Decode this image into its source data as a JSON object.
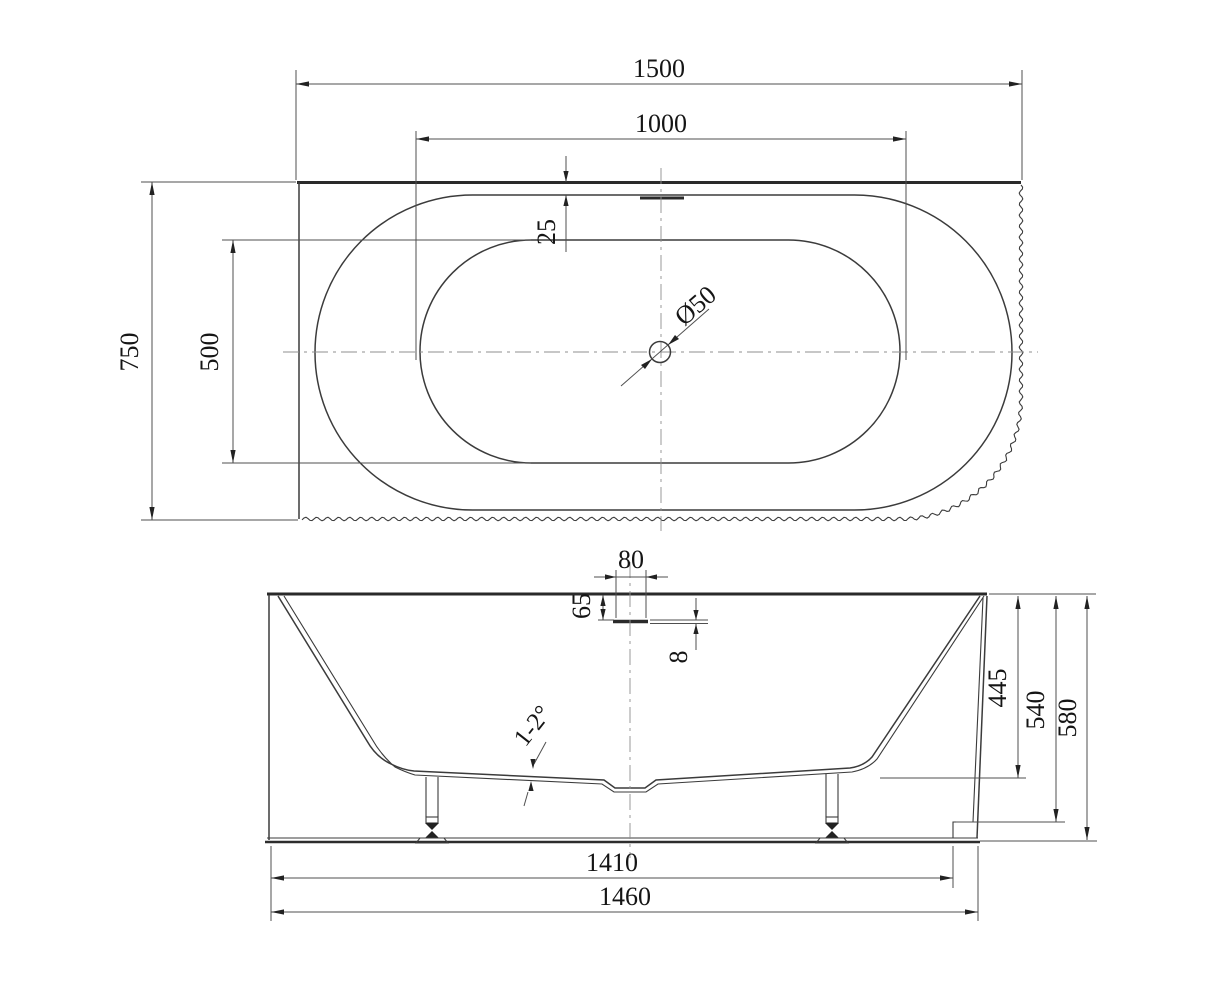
{
  "drawing_title": "Bathtub technical drawing (plan and elevation)",
  "top_view": {
    "overall_length": "1500",
    "basin_length": "1000",
    "overall_width": "750",
    "basin_width": "500",
    "rim_offset": "25",
    "drain_diameter": "Ø50"
  },
  "side_view": {
    "overflow_width": "80",
    "overflow_drop": "65",
    "overflow_gap": "8",
    "inner_depth": "445",
    "skirt_height": "540",
    "overall_height": "580",
    "base_length": "1410",
    "overall_length": "1460",
    "bottom_slope": "1-2°"
  }
}
